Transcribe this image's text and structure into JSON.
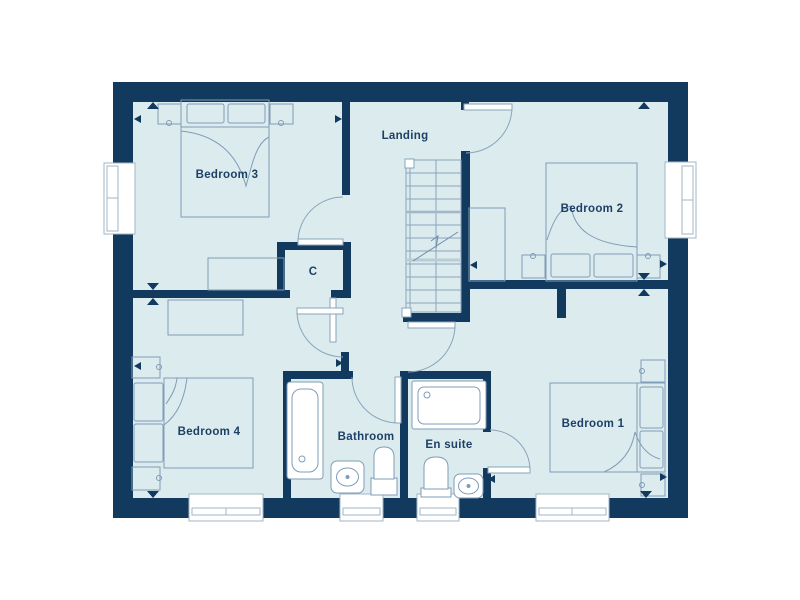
{
  "plan": {
    "type": "floor-plan",
    "rooms": {
      "bedroom3": {
        "label": "Bedroom 3"
      },
      "landing": {
        "label": "Landing"
      },
      "bedroom2": {
        "label": "Bedroom 2"
      },
      "bedroom4": {
        "label": "Bedroom 4"
      },
      "bathroom": {
        "label": "Bathroom"
      },
      "ensuite": {
        "label": "En suite"
      },
      "bedroom1": {
        "label": "Bedroom 1"
      },
      "closet": {
        "label": "C"
      }
    },
    "colors": {
      "wall": "#123a5f",
      "floor": "#dcecee",
      "furniture_line": "#7f9cb8",
      "window_frame": "#a2b6c6",
      "label_text": "#1d4066",
      "background": "#ffffff"
    }
  }
}
